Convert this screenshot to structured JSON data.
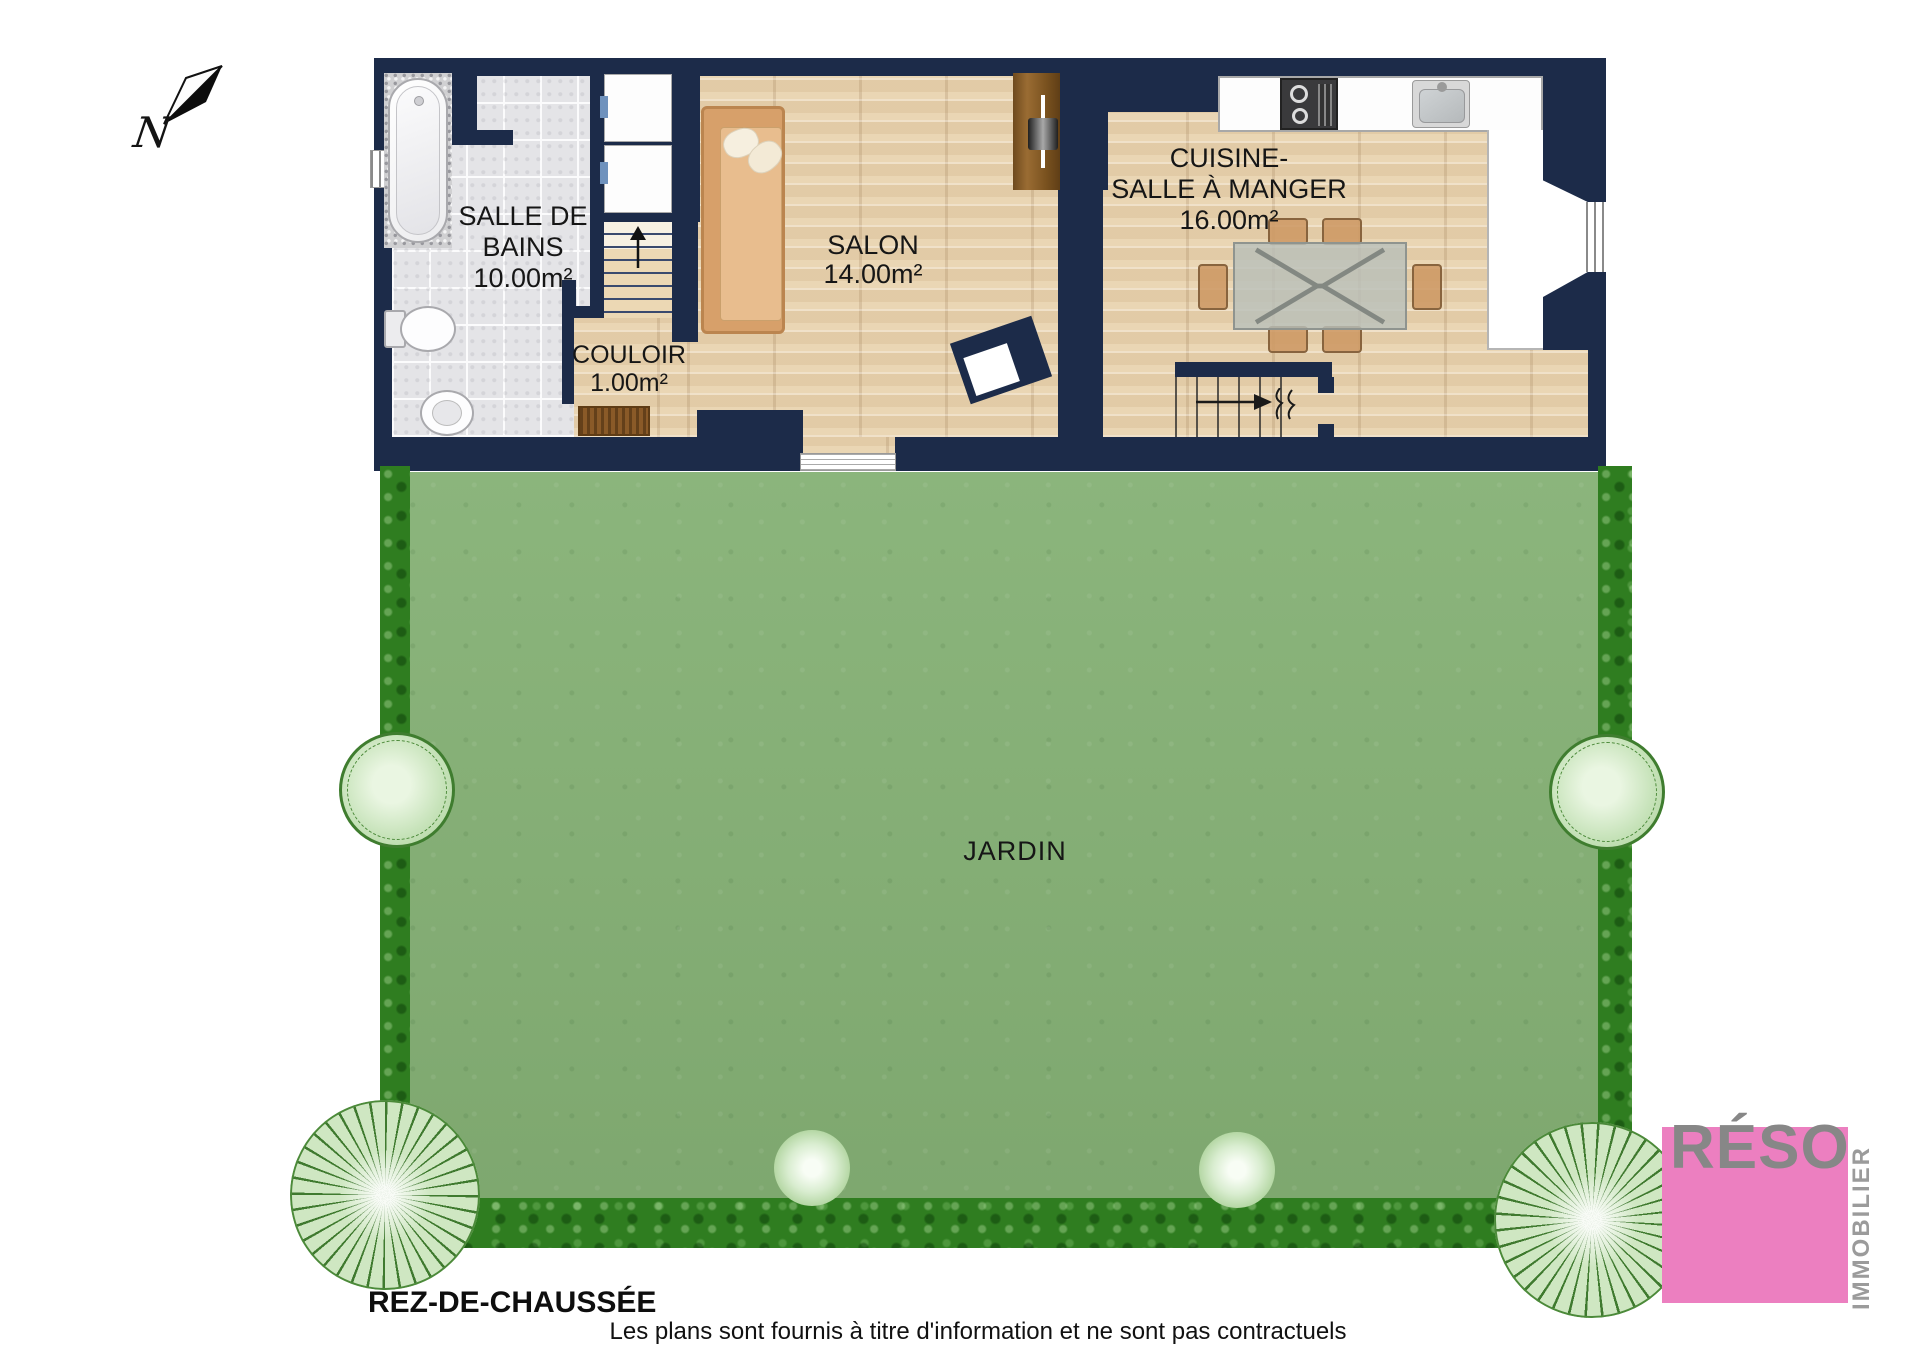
{
  "page": {
    "floor_label": "REZ-DE-CHAUSSÉE",
    "disclaimer": "Les plans sont fournis à titre d'information et ne sont pas contractuels"
  },
  "compass": {
    "north_label": "N"
  },
  "rooms": {
    "bathroom": {
      "name_line1": "SALLE DE",
      "name_line2": "BAINS",
      "area": "10.00m²"
    },
    "living": {
      "name": "SALON",
      "area": "14.00m²"
    },
    "hallway": {
      "name": "COULOIR",
      "area": "1.00m²"
    },
    "kitchen": {
      "name_line1": "CUISINE-",
      "name_line2": "SALLE À MANGER",
      "area": "16.00m²"
    },
    "garden": {
      "name": "JARDIN"
    }
  },
  "logo": {
    "brand": "RÉSO",
    "tagline": "IMMOBILIER"
  },
  "colors": {
    "wall_navy": "#1c2b49",
    "wood_floor": "#ead6b4",
    "tile_gray": "#e4e4e7",
    "grass_green": "#85b175",
    "hedge_green": "#2f7d20",
    "logo_pink": "#ec7fc0",
    "logo_gray": "#878787"
  }
}
